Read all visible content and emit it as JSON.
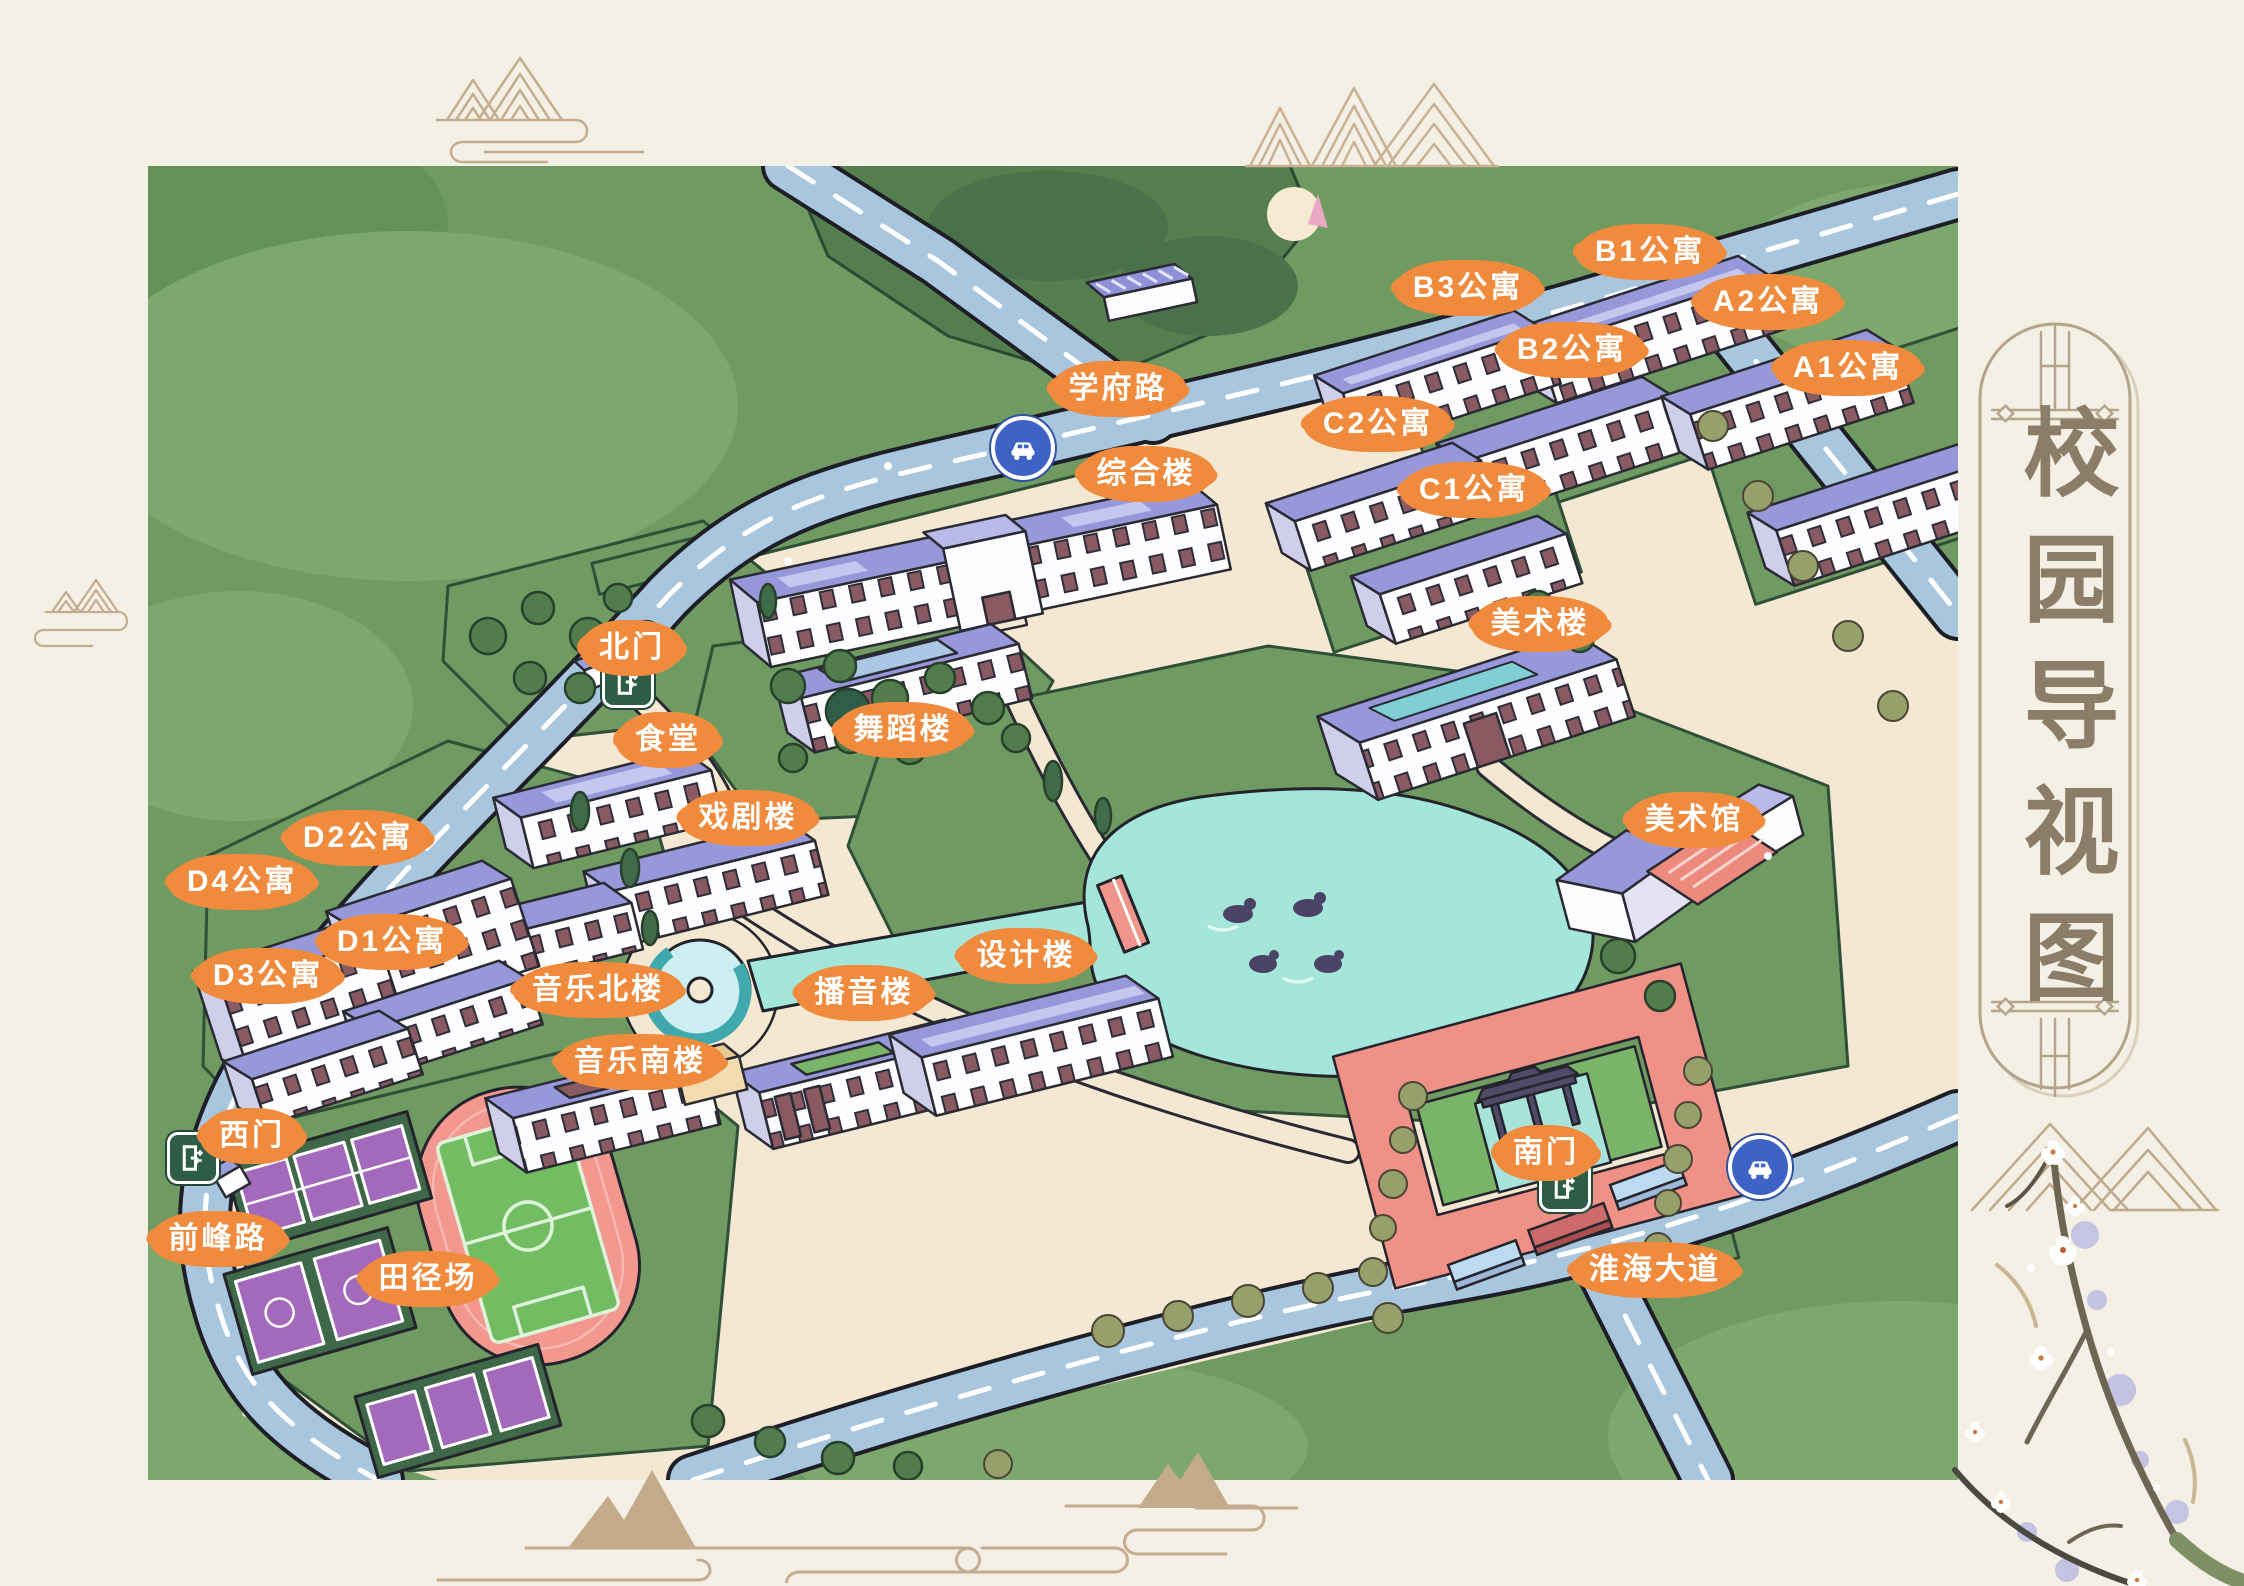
{
  "sidebar": {
    "title": "校园导视图"
  },
  "map": {
    "labels": [
      {
        "id": "xuefu-road",
        "text": "学府路",
        "x": 970,
        "y": 223
      },
      {
        "id": "zonghelou",
        "text": "综合楼",
        "x": 998,
        "y": 308
      },
      {
        "id": "b1-apartment",
        "text": "B1公寓",
        "x": 1502,
        "y": 86
      },
      {
        "id": "b3-apartment",
        "text": "B3公寓",
        "x": 1320,
        "y": 122
      },
      {
        "id": "b2-apartment",
        "text": "B2公寓",
        "x": 1424,
        "y": 184
      },
      {
        "id": "a2-apartment",
        "text": "A2公寓",
        "x": 1620,
        "y": 136
      },
      {
        "id": "a1-apartment",
        "text": "A1公寓",
        "x": 1700,
        "y": 202
      },
      {
        "id": "c2-apartment",
        "text": "C2公寓",
        "x": 1230,
        "y": 258
      },
      {
        "id": "c1-apartment",
        "text": "C1公寓",
        "x": 1326,
        "y": 324
      },
      {
        "id": "meishulou",
        "text": "美术楼",
        "x": 1392,
        "y": 458
      },
      {
        "id": "beimen",
        "text": "北门",
        "x": 484,
        "y": 482
      },
      {
        "id": "shitang",
        "text": "食堂",
        "x": 520,
        "y": 574
      },
      {
        "id": "wudaolou",
        "text": "舞蹈楼",
        "x": 755,
        "y": 564
      },
      {
        "id": "xijulou",
        "text": "戏剧楼",
        "x": 600,
        "y": 652
      },
      {
        "id": "d2-apartment",
        "text": "D2公寓",
        "x": 210,
        "y": 672
      },
      {
        "id": "d4-apartment",
        "text": "D4公寓",
        "x": 94,
        "y": 716
      },
      {
        "id": "d1-apartment",
        "text": "D1公寓",
        "x": 244,
        "y": 776
      },
      {
        "id": "d3-apartment",
        "text": "D3公寓",
        "x": 120,
        "y": 810
      },
      {
        "id": "meishuguan",
        "text": "美术馆",
        "x": 1546,
        "y": 654
      },
      {
        "id": "yinyue-north",
        "text": "音乐北楼",
        "x": 450,
        "y": 824
      },
      {
        "id": "boyinlou",
        "text": "播音楼",
        "x": 716,
        "y": 827
      },
      {
        "id": "shejilou",
        "text": "设计楼",
        "x": 878,
        "y": 790
      },
      {
        "id": "yinyue-south",
        "text": "音乐南楼",
        "x": 492,
        "y": 896
      },
      {
        "id": "ximen",
        "text": "西门",
        "x": 104,
        "y": 970
      },
      {
        "id": "qianfeng-road",
        "text": "前峰路",
        "x": 70,
        "y": 1073
      },
      {
        "id": "tianjingchang",
        "text": "田径场",
        "x": 280,
        "y": 1113
      },
      {
        "id": "nanmen",
        "text": "南门",
        "x": 1398,
        "y": 987
      },
      {
        "id": "huaihai-avenue",
        "text": "淮海大道",
        "x": 1507,
        "y": 1104
      }
    ],
    "gates": [
      {
        "id": "north",
        "x": 480,
        "y": 516
      },
      {
        "id": "west",
        "x": 45,
        "y": 992
      },
      {
        "id": "south",
        "x": 1417,
        "y": 1020
      }
    ],
    "cars": [
      {
        "id": "xuefu-road",
        "x": 875,
        "y": 282
      },
      {
        "id": "huaihai-avenue",
        "x": 1612,
        "y": 1001
      }
    ],
    "colors": {
      "badge_orange": "#f08a3c",
      "road_blue": "#a9c6df",
      "lake_teal": "#a4e6d9",
      "lawn_green": "#6f9b62",
      "roof_purple": "#9698da",
      "gate_green": "#2d5c47",
      "car_blue": "#3e63c6",
      "decoration_tan": "#c3ac8e",
      "page_cream": "#f4f0e5"
    }
  }
}
